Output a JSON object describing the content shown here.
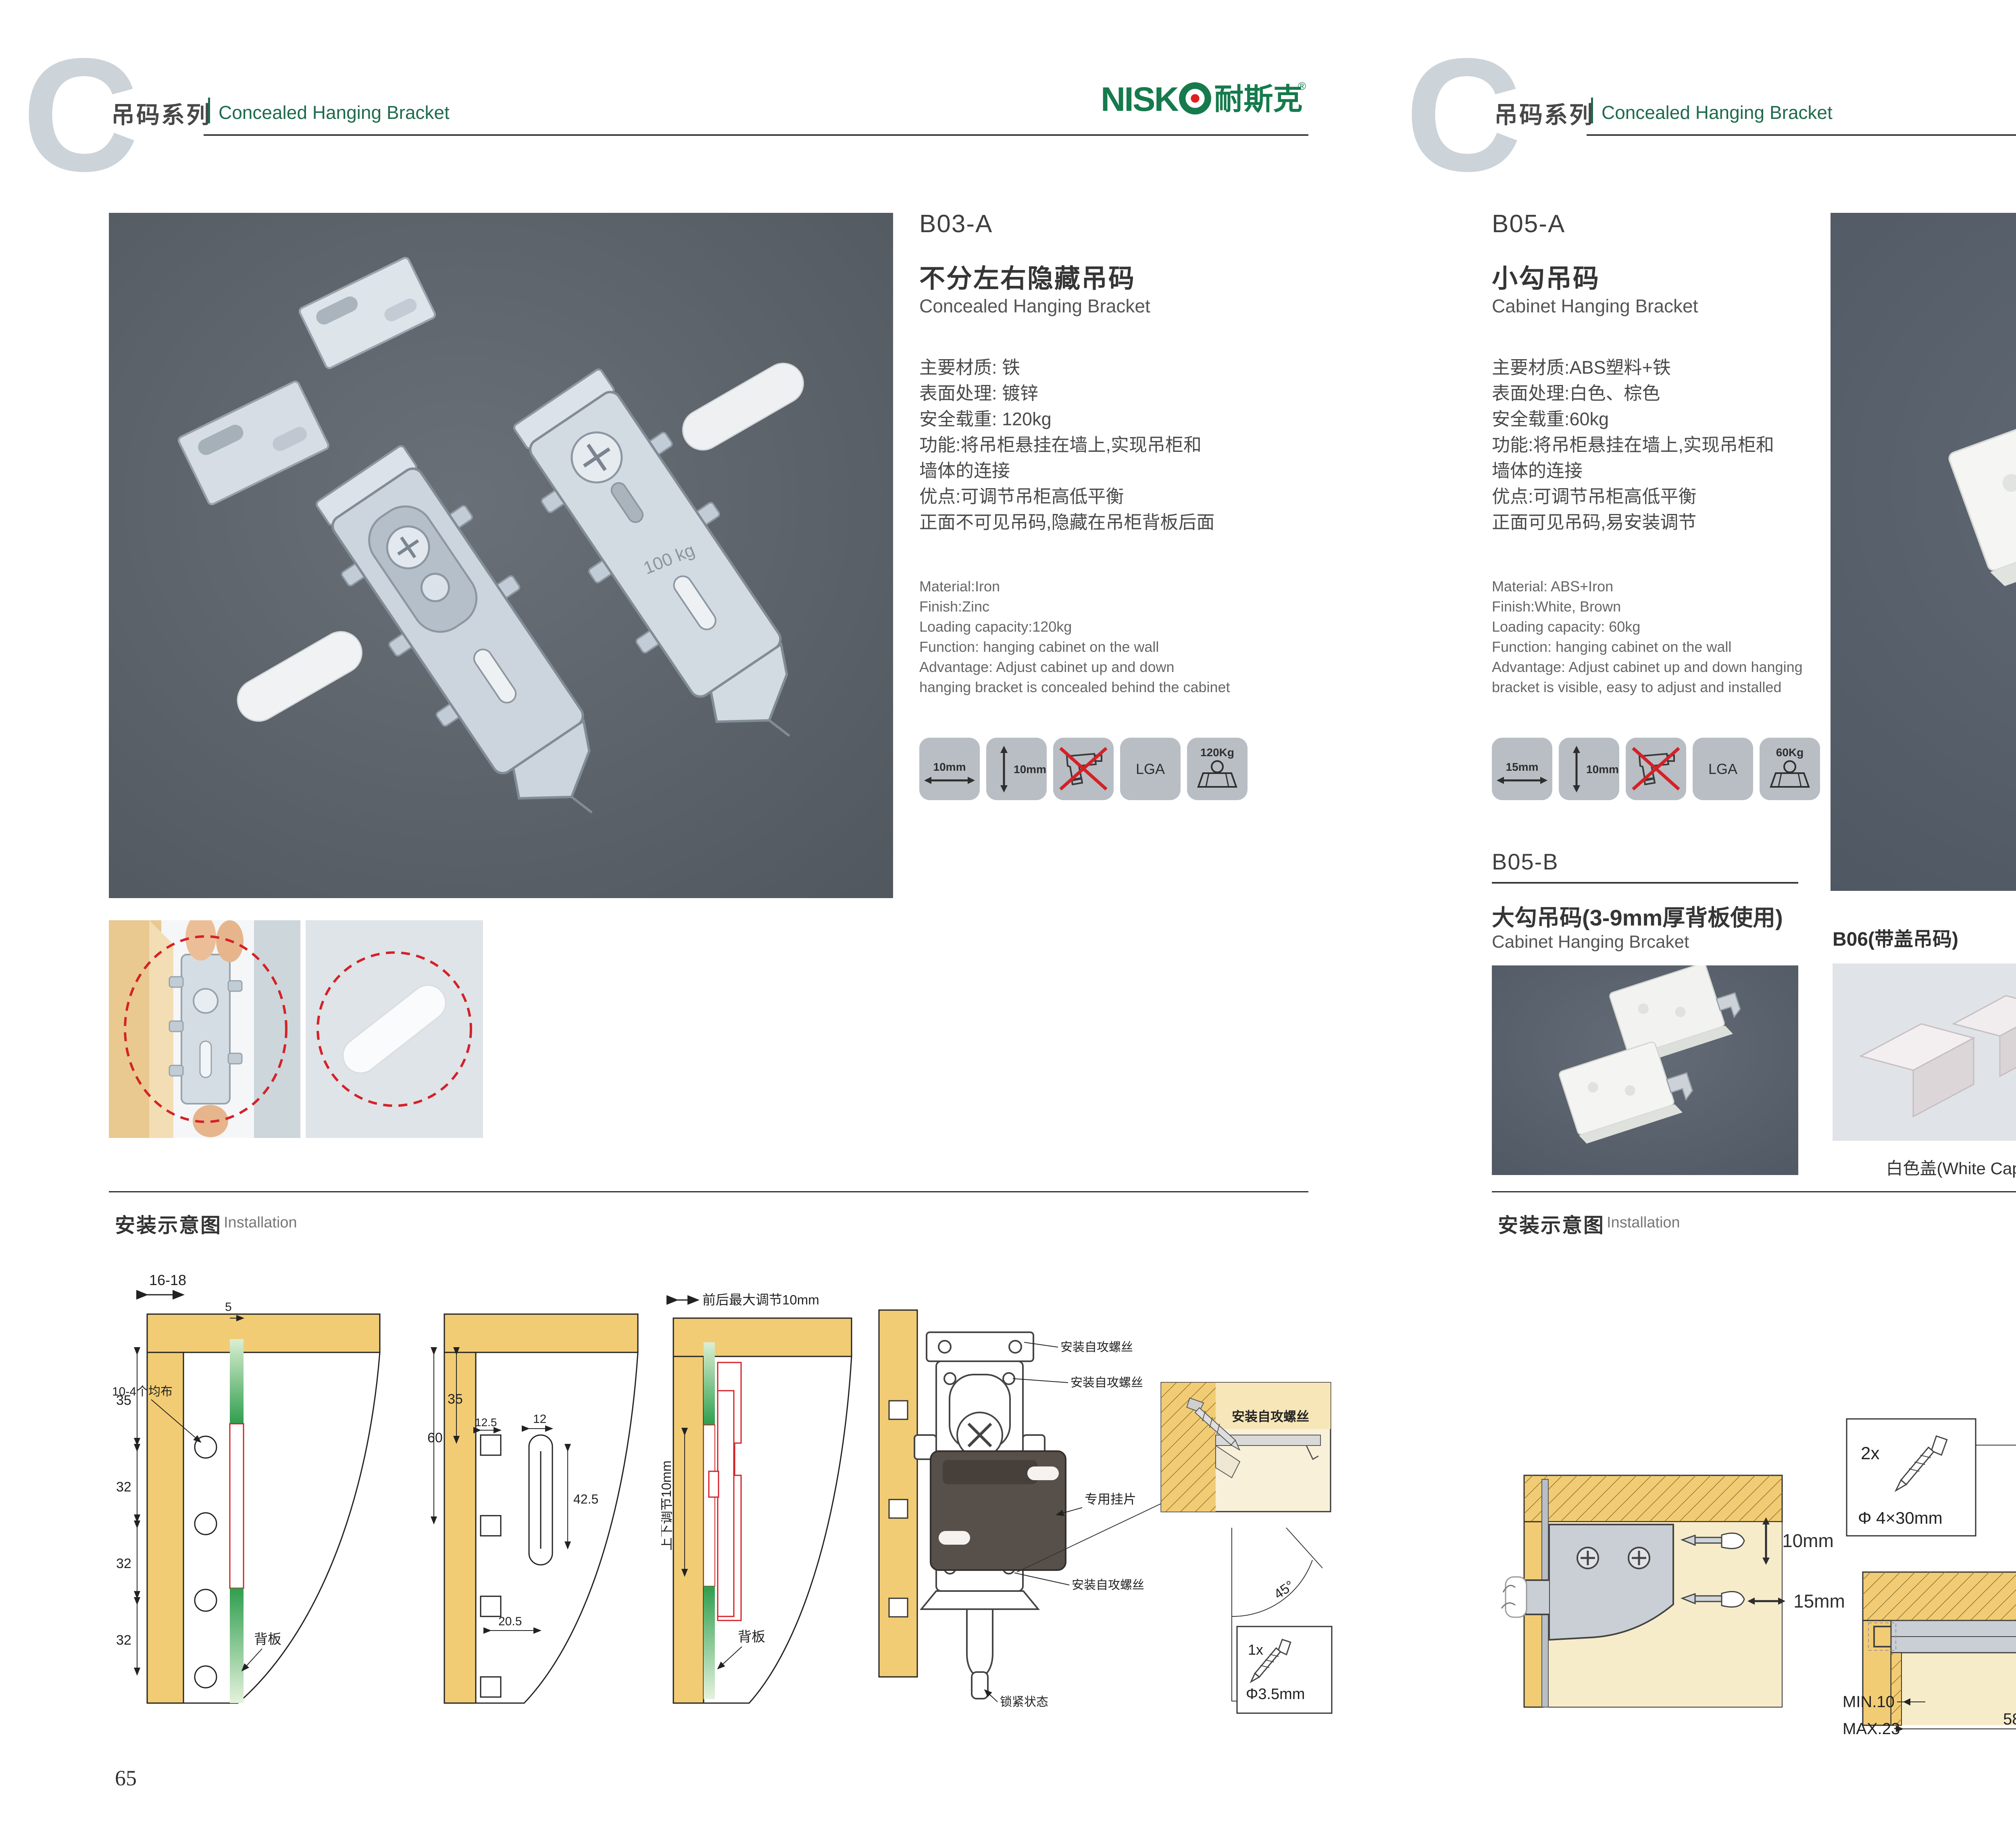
{
  "brand": {
    "logo_en": "NISK",
    "logo_cn": "耐斯克",
    "reg": "®"
  },
  "header": {
    "letter": "C",
    "series_cn": "吊码系列",
    "series_en": "Concealed Hanging Bracket"
  },
  "install_header": {
    "cn": "安装示意图",
    "en": "Installation"
  },
  "page65": {
    "number": "65",
    "product": {
      "code": "B03-A",
      "name_cn": "不分左右隐藏吊码",
      "name_en": "Concealed Hanging Bracket",
      "photo_stamp": "100 kg",
      "specs_cn": [
        "主要材质: 铁",
        "表面处理: 镀锌",
        "安全载重: 120kg",
        "功能:将吊柜悬挂在墙上,实现吊柜和",
        "墙体的连接",
        "优点:可调节吊柜高低平衡",
        "正面不可见吊码,隐藏在吊柜背板后面"
      ],
      "specs_en": [
        "Material:Iron",
        "Finish:Zinc",
        "Loading capacity:120kg",
        "Function: hanging cabinet on the wall",
        "Advantage: Adjust cabinet up and down",
        "hanging bracket is concealed behind the cabinet"
      ],
      "icons": {
        "w": "10mm",
        "h": "10mm",
        "cert": "LGA",
        "load": "120Kg"
      }
    },
    "install": {
      "d1": {
        "dim_top": "16-18",
        "dim_top2": "5",
        "dims_left": [
          "35",
          "32",
          "32",
          "32"
        ],
        "note_holes": "10-4个均布",
        "note_back": "背板"
      },
      "d2": {
        "d60": "60",
        "d35": "35",
        "d125": "12.5",
        "d12": "12",
        "d425": "42.5",
        "d205": "20.5"
      },
      "d3": {
        "top": "前后最大调节10mm",
        "left": "上下调节10mm",
        "back": "背板"
      },
      "d4": {
        "screw_label": "安装自攻螺丝",
        "plate": "专用挂片",
        "lock": "锁紧状态",
        "angle": "45°",
        "qty": "1x",
        "dia": "Φ3.5mm"
      }
    }
  },
  "page66": {
    "number": "66",
    "product": {
      "code": "B05-A",
      "name_cn": "小勾吊码",
      "name_en": "Cabinet Hanging Bracket",
      "specs_cn": [
        "主要材质:ABS塑料+铁",
        "表面处理:白色、棕色",
        "安全载重:60kg",
        "功能:将吊柜悬挂在墙上,实现吊柜和",
        "墙体的连接",
        "优点:可调节吊柜高低平衡",
        "正面可见吊码,易安装调节"
      ],
      "specs_en": [
        "Material: ABS+Iron",
        "Finish:White, Brown",
        "Loading capacity: 60kg",
        "Function: hanging cabinet on the wall",
        "Advantage: Adjust cabinet up and down hanging",
        "bracket is visible, easy to adjust and installed"
      ],
      "icons": {
        "w": "15mm",
        "h": "10mm",
        "cert": "LGA",
        "load": "60Kg"
      }
    },
    "product_b": {
      "code": "B05-B",
      "name_cn": "大勾吊码",
      "name_cn_red": "(3-9mm厚背板使用)",
      "name_en": "Cabinet Hanging Brcaket"
    },
    "b06": {
      "title": "B06(带盖吊码)",
      "caps": [
        "白色盖(White Cap)",
        "灰色盖(Gray Cap)",
        "银色盖(Silver Cap)"
      ]
    },
    "install": {
      "left": {
        "v": "10mm",
        "h": "15mm"
      },
      "mid": {
        "qty": "2x",
        "dia": "Φ 4×30mm",
        "min": "MIN.10",
        "max": "MAX.23",
        "d58": "58",
        "d18": "18"
      },
      "right": {
        "rmax": "RMAX4",
        "d42": "42",
        "d16": "16",
        "d17": "17",
        "d32": "32",
        "d16b": "16"
      }
    }
  }
}
